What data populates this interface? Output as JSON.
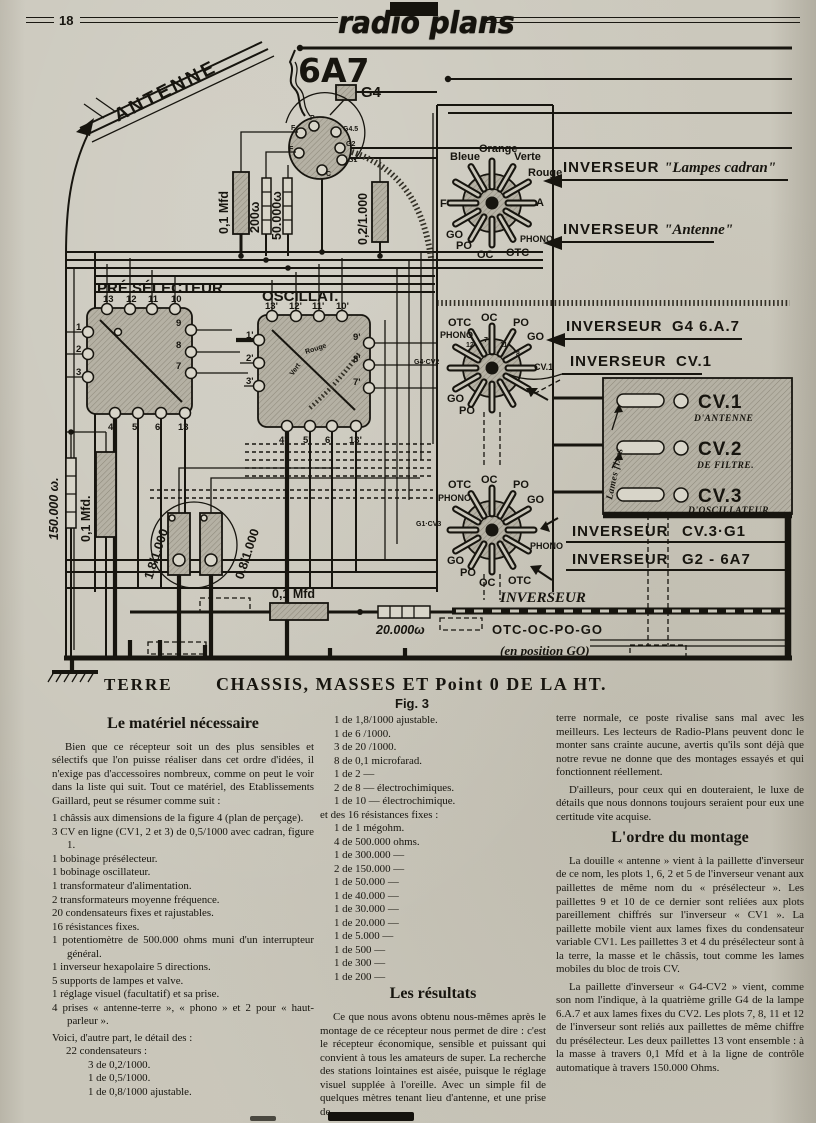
{
  "page": {
    "number": "18",
    "magazine": "radio plans"
  },
  "schematic": {
    "antenna_label": "ANTENNE",
    "tube_label": "6A7",
    "g4_label": "G4",
    "socket_pins": [
      "F",
      "P",
      "G4.5",
      "G2",
      "G1",
      "C"
    ],
    "cap_01_top": "0,1 Mfd",
    "r_200": "200ω",
    "r_50000": "50.000ω",
    "cap_02": "0,2/1.000",
    "presel": {
      "label": "PRÉ SÉLECTEUR",
      "pins_top": [
        "13",
        "12",
        "11",
        "10"
      ],
      "pins_left": [
        "1",
        "2",
        "3"
      ],
      "pins_right": [
        "9",
        "8",
        "7"
      ],
      "pins_bottom": [
        "4",
        "5",
        "6",
        "13"
      ]
    },
    "oscil": {
      "label": "OSCILLAT.",
      "pins_top": [
        "13'",
        "12'",
        "11'",
        "10'"
      ],
      "pins_left": [
        "1'",
        "2'",
        "3'"
      ],
      "pins_right": [
        "9'",
        "8'",
        "7'"
      ],
      "pins_bottom": [
        "4'",
        "5'",
        "6'",
        "13'"
      ],
      "wire_red": "Rouge",
      "wire_green": "Vert"
    },
    "sw1": {
      "labels": [
        "Bleue",
        "Orange",
        "Verte",
        "Rouge",
        "F'",
        "A",
        "GO",
        "PO",
        "OC",
        "OTC",
        "PHONO"
      ]
    },
    "sw2": {
      "labels": [
        "OTC",
        "OC",
        "PO",
        "PHONO",
        "GO",
        "G4·CV2",
        "CV.1",
        "GO",
        "PO"
      ],
      "nums": [
        "12",
        "7",
        "11",
        "8"
      ]
    },
    "sw3": {
      "labels": [
        "OTC",
        "OC",
        "PO",
        "PHONO",
        "GO",
        "G1·CV3",
        "PHONO",
        "GO",
        "PO",
        "OC",
        "OTC"
      ]
    },
    "inv_lampes": {
      "name": "INVERSEUR",
      "detail": "\"Lampes cadran\""
    },
    "inv_antenne": {
      "name": "INVERSEUR",
      "detail": "\"Antenne\""
    },
    "inv_g4": {
      "name": "INVERSEUR",
      "detail": "G4  6.A.7"
    },
    "inv_cv1": {
      "name": "INVERSEUR",
      "detail": "CV.1"
    },
    "inv_cv3": {
      "name": "INVERSEUR",
      "detail": "CV.3·G1"
    },
    "inv_g2": {
      "name": "INVERSEUR",
      "detail": "G2 - 6A7"
    },
    "cv_block": {
      "lames": "Lames fixes",
      "cv1": "CV.1",
      "cv1_sub": "D'ANTENNE",
      "cv2": "CV.2",
      "cv2_sub": "DE FILTRE.",
      "cv3": "CV.3",
      "cv3_sub": "D'OSCILLATEUR"
    },
    "r_150000": "150.000 ω.",
    "cap_01_left": "0,1 Mfd.",
    "trim_18": "1,8/1.000",
    "trim_08": "0,8/1.000",
    "cap_01_bottom": "0,1 Mfd",
    "r_20000": "20.000ω",
    "inv_bus": "INVERSEUR",
    "inv_bus_positions": "OTC-OC-PO-GO",
    "inv_bus_note": "(en position GO)",
    "terre": "TERRE",
    "chassis": "CHASSIS, MASSES ET Point 0 DE LA HT.",
    "fig": "Fig. 3"
  },
  "left_column": {
    "heading": "Le matériel nécessaire",
    "intro": "Bien que ce récepteur soit un des plus sensibles et sélectifs que l'on puisse réaliser dans cet ordre d'idées, il n'exige pas d'accessoires nombreux, comme on peut le voir dans la liste qui suit. Tout ce matériel, des Etablissements Gaillard, peut se résumer comme suit :",
    "items": [
      "1 châssis aux dimensions de la figure 4 (plan de perçage).",
      "3 CV en ligne (CV1, 2 et 3) de 0,5/1000 avec cadran, figure 1.",
      "1 bobinage présélecteur.",
      "1 bobinage oscillateur.",
      "1 transformateur d'alimentation.",
      "2 transformateurs moyenne fréquence.",
      "20 condensateurs fixes et rajustables.",
      "16 résistances fixes.",
      "1 potentiomètre de 500.000 ohms muni d'un interrupteur général.",
      "1 inverseur hexapolaire 5 directions.",
      "5 supports de lampes et valve.",
      "1 réglage visuel (facultatif) et sa prise.",
      "4 prises « antenne-terre », « phono » et 2 pour « haut-parleur »."
    ],
    "detail_intro": "Voici, d'autre part, le détail des :",
    "cond_heading": "22 condensateurs :",
    "cond_items": [
      "3 de  0,2/1000.",
      "1 de  0,5/1000.",
      "1 de  0,8/1000 ajustable."
    ]
  },
  "middle_column": {
    "cond_items": [
      "1 de  1,8/1000 ajustable.",
      "1 de  6  /1000.",
      "3 de 20  /1000.",
      "8 de  0,1 microfarad.",
      "1 de  2        —",
      "2 de  8        —      électrochimiques.",
      "1 de 10       —      électrochimique."
    ],
    "res_heading": "et des 16 résistances fixes :",
    "res_items": [
      "1 de 1 mégohm.",
      "4 de 500.000 ohms.",
      "1 de 300.000  —",
      "2 de 150.000  —",
      "1 de  50.000  —",
      "1 de  40.000  —",
      "1 de  30.000  —",
      "1 de  20.000  —",
      "1 de   5.000  —",
      "1 de     500  —",
      "1 de     300  —",
      "1 de     200  —"
    ],
    "results_heading": "Les résultats",
    "results_text": "Ce que nous avons obtenu nous-mêmes après le montage de ce récepteur nous permet de dire : c'est le récepteur économique, sensible et puissant qui convient à tous les amateurs de super. La recherche des stations lointaines est aisée, puisque le réglage visuel supplée à l'oreille. Avec un simple fil de quelques mètres tenant lieu d'antenne, et une prise de"
  },
  "right_column": {
    "p1": "terre normale, ce poste rivalise sans mal avec les meilleurs. Les lecteurs de Radio-Plans peuvent donc le monter sans crainte aucune, avertis qu'ils sont déjà que notre revue ne donne que des montages essayés et qui fonctionnent réellement.",
    "p2": "D'ailleurs, pour ceux qui en douteraient, le luxe de détails que nous donnons toujours seraient pour eux une certitude vite acquise.",
    "montage_heading": "L'ordre du montage",
    "p3": "La douille « antenne » vient à la paillette d'inverseur de ce nom, les plots 1, 6, 2 et 5 de l'inverseur venant aux paillettes de même nom du « présélecteur ». Les paillettes 9 et 10 de ce dernier sont reliées aux plots pareillement chiffrés sur l'inverseur « CV1 ». La paillette mobile vient aux lames fixes du condensateur variable CV1. Les paillettes 3 et 4 du présélecteur sont à la terre, la masse et le châssis, tout comme les lames mobiles du bloc de trois CV.",
    "p4": "La paillette d'inverseur « G4-CV2 » vient, comme son nom l'indique, à la quatrième grille G4 de la lampe 6.A.7 et aux lames fixes du CV2. Les plots 7, 8, 11 et 12 de l'inverseur sont reliés aux paillettes de même chiffre du présélecteur. Les deux paillettes 13 vont ensemble : à la masse à travers 0,1 Mfd et à la ligne de contrôle automatique à travers 150.000 Ohms."
  }
}
